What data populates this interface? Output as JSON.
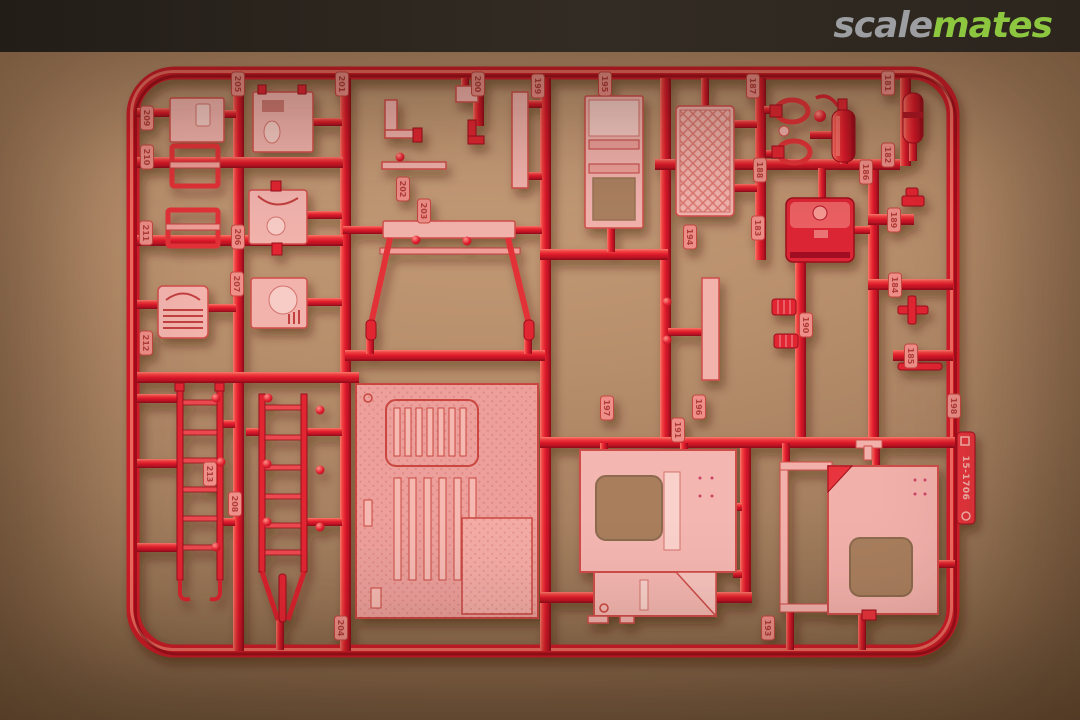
{
  "watermark": {
    "brand_gray": "scale",
    "brand_green": "mates",
    "colors": {
      "gray": "#9c9ea1",
      "green": "#8dc63f",
      "bar": "#2b241d"
    }
  },
  "photo": {
    "subject": "Red plastic model kit sprue photographed on brown cardboard",
    "colors": {
      "sprue_red": "#e01b2d",
      "parts_pink": "#f2b3ad",
      "cardboard": "#ad8565"
    },
    "sprue": {
      "mold_label": "15-1706",
      "visible_parts": [
        "fire-extinguisher",
        "fuel-tank",
        "radiator-grille",
        "engine-block",
        "winch",
        "ladder",
        "ladder-with-support",
        "windshield-frame",
        "roller-door-panel",
        "mesh-panel",
        "truck-bed",
        "cab-side-panel-left",
        "cab-side-panel-right",
        "pipe-clamp",
        "cylinder",
        "coil",
        "plank",
        "bracket"
      ],
      "tabs": [
        {
          "n": "181",
          "x": 888,
          "y": 83
        },
        {
          "n": "182",
          "x": 888,
          "y": 155
        },
        {
          "n": "183",
          "x": 758,
          "y": 228
        },
        {
          "n": "184",
          "x": 895,
          "y": 285
        },
        {
          "n": "185",
          "x": 911,
          "y": 356
        },
        {
          "n": "186",
          "x": 866,
          "y": 172
        },
        {
          "n": "187",
          "x": 753,
          "y": 86
        },
        {
          "n": "188",
          "x": 760,
          "y": 170
        },
        {
          "n": "189",
          "x": 894,
          "y": 220
        },
        {
          "n": "190",
          "x": 806,
          "y": 325
        },
        {
          "n": "191",
          "x": 678,
          "y": 430
        },
        {
          "n": "193",
          "x": 768,
          "y": 628
        },
        {
          "n": "194",
          "x": 690,
          "y": 237
        },
        {
          "n": "195",
          "x": 605,
          "y": 84
        },
        {
          "n": "196",
          "x": 699,
          "y": 407
        },
        {
          "n": "197",
          "x": 607,
          "y": 408
        },
        {
          "n": "198",
          "x": 954,
          "y": 406
        },
        {
          "n": "199",
          "x": 538,
          "y": 86
        },
        {
          "n": "200",
          "x": 478,
          "y": 84
        },
        {
          "n": "201",
          "x": 342,
          "y": 84
        },
        {
          "n": "202",
          "x": 403,
          "y": 189
        },
        {
          "n": "203",
          "x": 424,
          "y": 211
        },
        {
          "n": "204",
          "x": 341,
          "y": 628
        },
        {
          "n": "205",
          "x": 238,
          "y": 84
        },
        {
          "n": "206",
          "x": 238,
          "y": 237
        },
        {
          "n": "207",
          "x": 237,
          "y": 284
        },
        {
          "n": "208",
          "x": 235,
          "y": 504
        },
        {
          "n": "209",
          "x": 147,
          "y": 118
        },
        {
          "n": "210",
          "x": 147,
          "y": 157
        },
        {
          "n": "211",
          "x": 146,
          "y": 233
        },
        {
          "n": "212",
          "x": 146,
          "y": 343
        },
        {
          "n": "213",
          "x": 210,
          "y": 474
        }
      ]
    }
  }
}
